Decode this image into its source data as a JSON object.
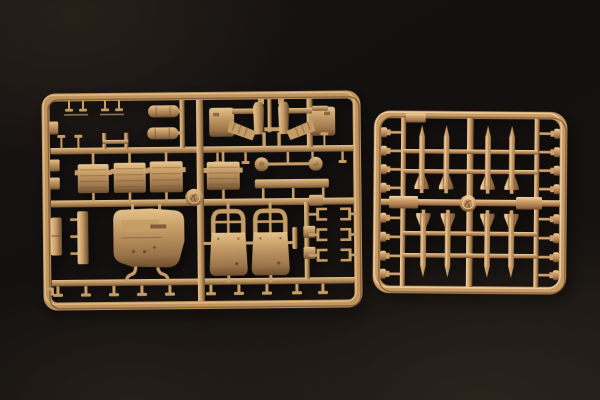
{
  "image": {
    "caption": "Two tan injection-molded plastic model kit sprues photographed on a dark background",
    "subject": "model kit parts frames"
  },
  "palette": {
    "background": "#131010",
    "background_glow_top_left": "#272019",
    "background_glow_bottom": "#2b241d",
    "left_sprue": {
      "base": "#c59c66",
      "highlight": "#e6c28c",
      "mid": "#c89e68",
      "shadow": "#9a744a",
      "deep": "#6e4e2d",
      "frame": "#c1945e"
    },
    "right_sprue": {
      "base": "#cb9e6a",
      "highlight": "#f2d4a4",
      "mid": "#d2a36d",
      "shadow": "#a2734a",
      "deep": "#6f4c2b",
      "frame": "#c89a64"
    }
  },
  "left_sprue": {
    "name": "large rectangular parts frame",
    "medallion": true,
    "parts": [
      "mirrored cockpit frame halves",
      "fuel tank cylinders",
      "ribbed radiator panels",
      "wheel discs on axle",
      "long step bar",
      "cab floor panel",
      "seat back panels",
      "bracket clips",
      "assorted posts and pins"
    ],
    "rows": {
      "top_post_pairs": 2,
      "standing_posts": 3,
      "hanging_posts": 4,
      "ribbed_panels": 4,
      "seats": 2,
      "clip_rows": 3,
      "bottom_posts": 10
    }
  },
  "right_sprue": {
    "name": "small square missile parts frame",
    "medallion": true,
    "missiles_top": 4,
    "missiles_bottom": 4,
    "bolt_parts_left": 8,
    "bolt_parts_right": 8
  }
}
